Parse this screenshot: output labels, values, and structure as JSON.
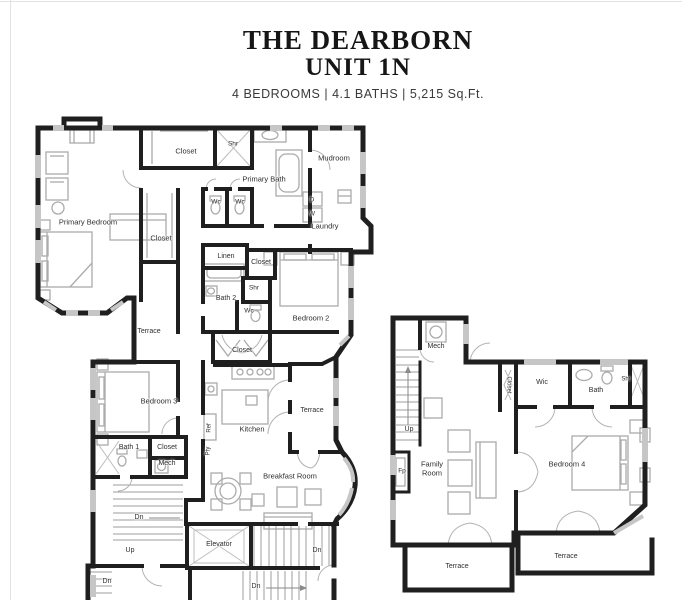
{
  "header": {
    "title_line1": "THE DEARBORN",
    "title_line2": "UNIT 1N",
    "subtitle": "4 BEDROOMS | 4.1 BATHS | 5,215 Sq.Ft."
  },
  "floorplan": {
    "wall_color": "#1f1f1f",
    "label_color": "#2e2e2e",
    "labels": [
      {
        "text": "Closet",
        "x": 186,
        "y": 152
      },
      {
        "text": "Shr",
        "x": 233,
        "y": 144,
        "size": 6.5
      },
      {
        "text": "Primary Bath",
        "x": 264,
        "y": 180,
        "w": 46
      },
      {
        "text": "Mudroom",
        "x": 334,
        "y": 159
      },
      {
        "text": "Primary Bedroom",
        "x": 88,
        "y": 223
      },
      {
        "text": "Wc",
        "x": 216,
        "y": 202,
        "size": 6.5
      },
      {
        "text": "Wc",
        "x": 240,
        "y": 202,
        "size": 6.5
      },
      {
        "text": "D",
        "x": 312,
        "y": 200,
        "size": 6.5
      },
      {
        "text": "W",
        "x": 312,
        "y": 214,
        "size": 6.5
      },
      {
        "text": "Laundry",
        "x": 325,
        "y": 227
      },
      {
        "text": "Closet",
        "x": 161,
        "y": 239
      },
      {
        "text": "Linen",
        "x": 226,
        "y": 257,
        "size": 7
      },
      {
        "text": "Closet",
        "x": 261,
        "y": 263,
        "size": 7
      },
      {
        "text": "Shr",
        "x": 254,
        "y": 288,
        "size": 6.5
      },
      {
        "text": "Bath 2",
        "x": 226,
        "y": 299,
        "size": 7
      },
      {
        "text": "Wc",
        "x": 249,
        "y": 311,
        "size": 6.5
      },
      {
        "text": "Bedroom 2",
        "x": 311,
        "y": 319
      },
      {
        "text": "Terrace",
        "x": 149,
        "y": 332,
        "size": 7
      },
      {
        "text": "Closet",
        "x": 242,
        "y": 351,
        "size": 7
      },
      {
        "text": "Bedroom 3",
        "x": 159,
        "y": 402
      },
      {
        "text": "Terrace",
        "x": 312,
        "y": 411,
        "size": 7
      },
      {
        "text": "Kitchen",
        "x": 252,
        "y": 430
      },
      {
        "text": "Ref",
        "x": 210,
        "y": 428,
        "rot": -90,
        "size": 6
      },
      {
        "text": "Pty",
        "x": 209,
        "y": 451,
        "rot": -90,
        "size": 6
      },
      {
        "text": "Bath 1",
        "x": 129,
        "y": 448,
        "size": 7
      },
      {
        "text": "Closet",
        "x": 167,
        "y": 448,
        "size": 7
      },
      {
        "text": "Mech",
        "x": 167,
        "y": 464,
        "size": 7
      },
      {
        "text": "Breakfast Room",
        "x": 290,
        "y": 477
      },
      {
        "text": "Dn",
        "x": 139,
        "y": 518,
        "size": 7
      },
      {
        "text": "Up",
        "x": 130,
        "y": 551,
        "size": 7
      },
      {
        "text": "Elevator",
        "x": 219,
        "y": 545,
        "size": 7
      },
      {
        "text": "Dn",
        "x": 317,
        "y": 551,
        "size": 7
      },
      {
        "text": "Dn",
        "x": 107,
        "y": 582,
        "size": 7
      },
      {
        "text": "Dn",
        "x": 256,
        "y": 587,
        "size": 7
      },
      {
        "text": "Mech",
        "x": 436,
        "y": 347,
        "size": 7
      },
      {
        "text": "Closet",
        "x": 508,
        "y": 385,
        "rot": 90,
        "size": 6
      },
      {
        "text": "Wic",
        "x": 542,
        "y": 383,
        "size": 7
      },
      {
        "text": "Bath",
        "x": 596,
        "y": 391,
        "size": 7
      },
      {
        "text": "Shr",
        "x": 626,
        "y": 380,
        "size": 6
      },
      {
        "text": "Up",
        "x": 409,
        "y": 430,
        "size": 7
      },
      {
        "text": "Fp",
        "x": 402,
        "y": 471,
        "size": 6.5
      },
      {
        "text": "Family Room",
        "x": 432,
        "y": 469,
        "w": 44
      },
      {
        "text": "Bedroom 4",
        "x": 567,
        "y": 465
      },
      {
        "text": "Terrace",
        "x": 457,
        "y": 567,
        "size": 7
      },
      {
        "text": "Terrace",
        "x": 566,
        "y": 557,
        "size": 7
      }
    ]
  }
}
